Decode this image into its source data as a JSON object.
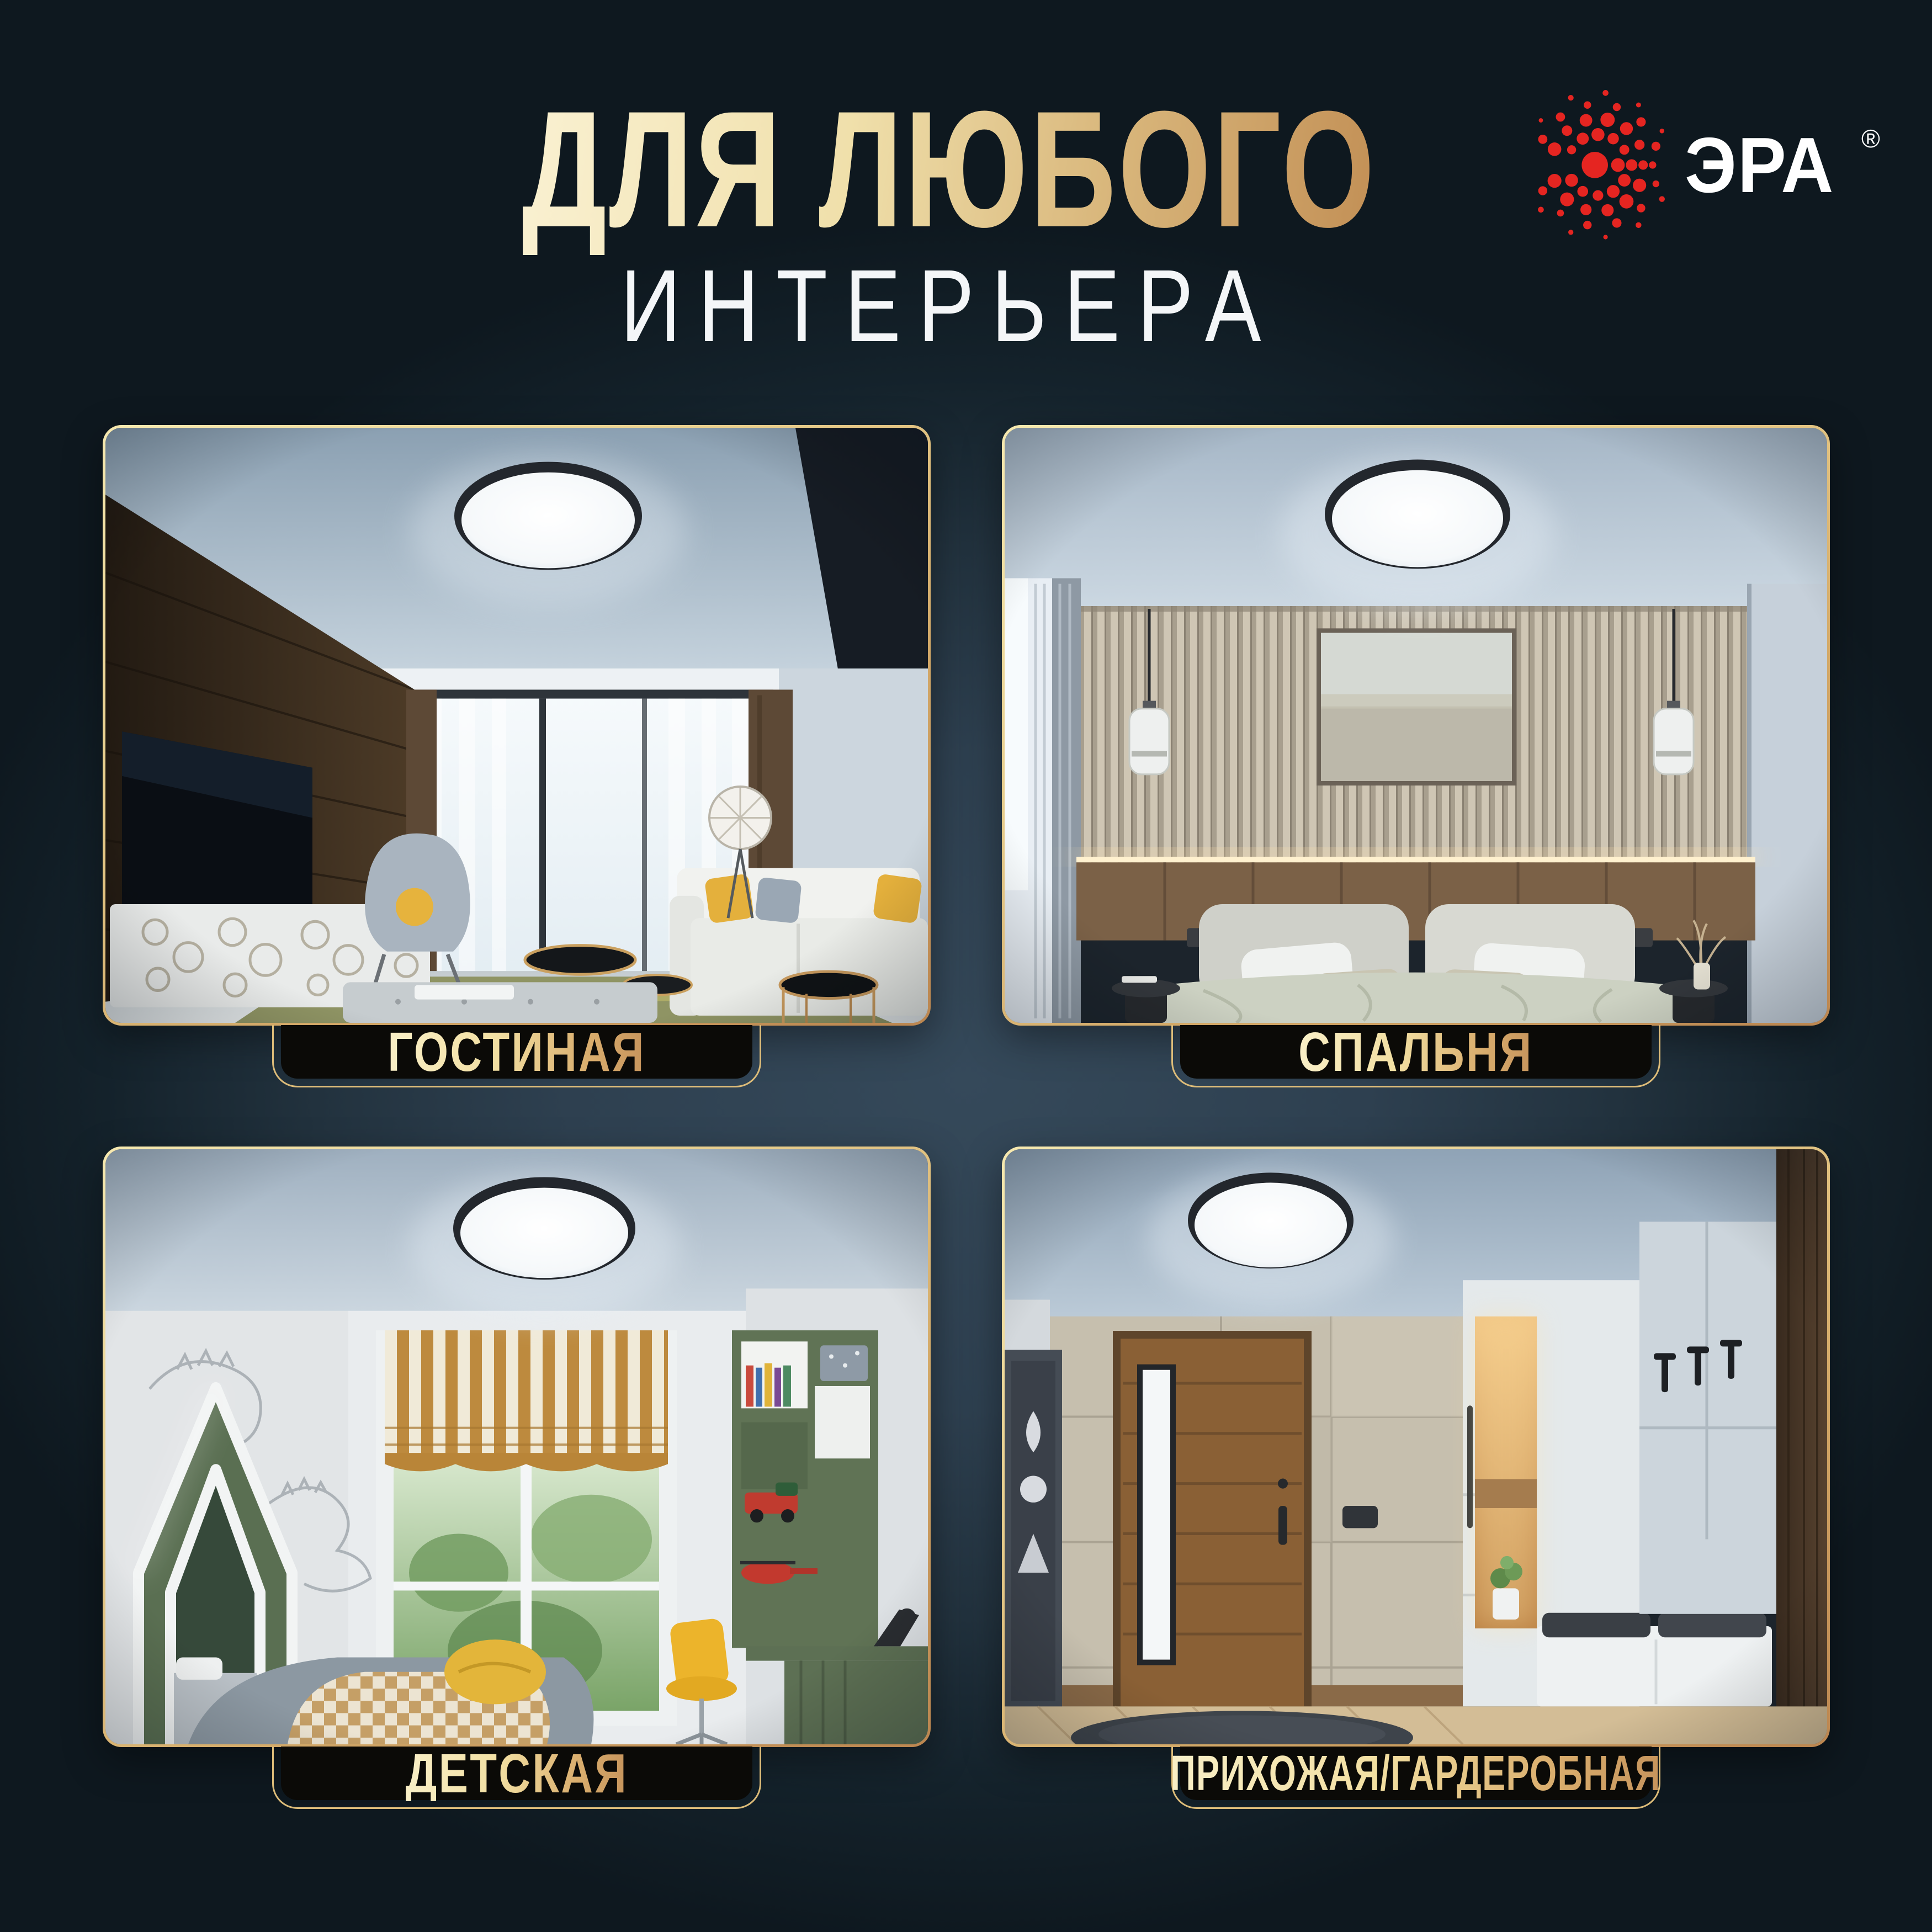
{
  "title": {
    "line1": "ДЛЯ ЛЮБОГО",
    "line2": "ИНТЕРЬЕРА"
  },
  "brand": {
    "name": "ЭРА",
    "registered_mark": "®",
    "dot_color": "#e52521",
    "text_color": "#ffffff"
  },
  "rooms": [
    {
      "label": "ГОСТИНАЯ"
    },
    {
      "label": "СПАЛЬНЯ"
    },
    {
      "label": "ДЕТСКАЯ"
    },
    {
      "label": "ПРИХОЖАЯ/ГАРДЕРОБНАЯ"
    }
  ],
  "colors": {
    "background_center": "#2e4050",
    "background_edge": "#0e181f",
    "gold_light": "#f6e9b0",
    "gold_dark": "#bb8650",
    "plate_background": "#0b0a07",
    "lamp_rim": "#23272d",
    "lamp_diffuser": "#ffffff"
  }
}
